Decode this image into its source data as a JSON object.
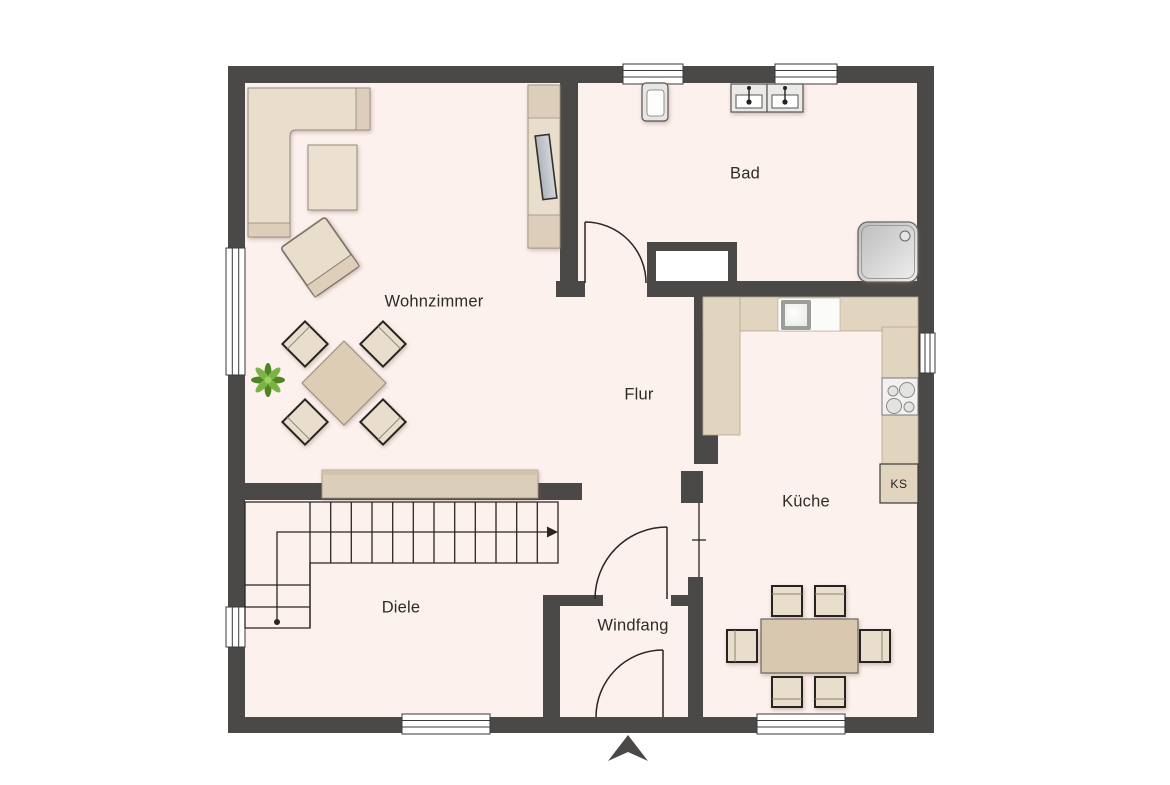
{
  "rooms": {
    "wohnzimmer": "Wohnzimmer",
    "bad": "Bad",
    "flur": "Flur",
    "kueche": "Küche",
    "diele": "Diele",
    "windfang": "Windfang"
  },
  "appliances": {
    "fridge": "KS"
  },
  "colors": {
    "wall": "#4a4947",
    "floor": "#fdf1ee",
    "counter": "#e2d5bf",
    "furniture_light": "#e9ddcb",
    "furniture_mid": "#dbceba",
    "table": "#d9c9b1",
    "tv_screen": "#c3c8cc",
    "plant_green": "#74ad3b",
    "line": "#2a2520"
  }
}
